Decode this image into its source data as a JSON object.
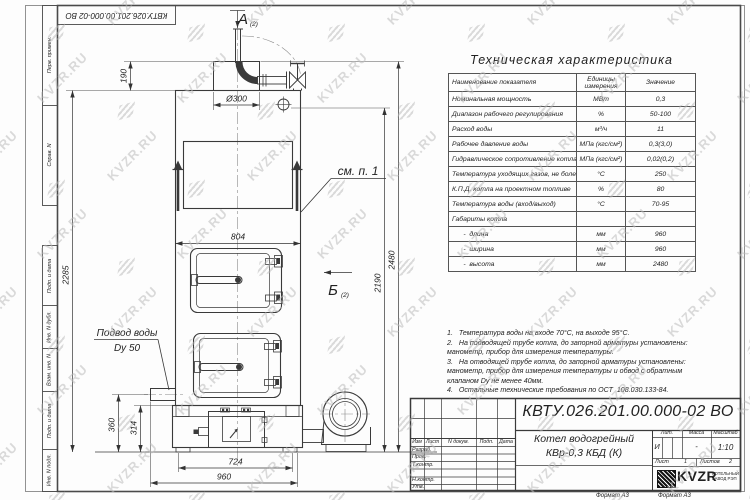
{
  "watermark": {
    "text": "KVZR.RU"
  },
  "frame": {
    "corner_designation": "КВТУ.026.201.00.000-02  ВО",
    "side_top_1": "Перв. примен.",
    "side_top_2": "Справ. N",
    "side_bot_1": "Подп. и дата",
    "side_bot_2": "Инв. N дубл.",
    "side_bot_3": "Взам. инв. N",
    "side_bot_4": "Подп. и дата",
    "side_bot_5": "Инв. N подл.",
    "format_label": "Формат А3"
  },
  "spec": {
    "title": "Техническая характеристика",
    "col_name": "Наименование показателя",
    "col_unit": "Единицы измерения",
    "col_value": "Значение",
    "rows": [
      {
        "name": "Номинальная мощность",
        "unit": "МВт",
        "value": "0,3"
      },
      {
        "name": "Диапазон рабочего регулирования",
        "unit": "%",
        "value": "50-100"
      },
      {
        "name": "Расход воды",
        "unit": "м³/ч",
        "value": "11"
      },
      {
        "name": "Рабочее давление воды",
        "unit": "МПа (кгс/см²)",
        "value": "0,3(3,0)"
      },
      {
        "name": "Гидравлическое сопротивление котла",
        "unit": "МПа (кгс/см²)",
        "value": "0,02(0,2)"
      },
      {
        "name": "Температура уходящих газов, не более",
        "unit": "°С",
        "value": "250"
      },
      {
        "name": "К.П.Д. котла на проектном топливе",
        "unit": "%",
        "value": "80"
      },
      {
        "name": "Температура воды (вход/выход)",
        "unit": "°С",
        "value": "70-95"
      },
      {
        "name": "Габариты котла",
        "unit": "",
        "value": ""
      },
      {
        "name": "      -  длина",
        "unit": "мм",
        "value": "960"
      },
      {
        "name": "      -  ширина",
        "unit": "мм",
        "value": "960"
      },
      {
        "name": "      -  высота",
        "unit": "мм",
        "value": "2480"
      }
    ]
  },
  "notes": {
    "lines": [
      "1.   Температура воды на входе 70°С, на выходе 95°С.",
      "2.   На подводящей трубе котла, до запорной арматуры установлены:",
      "манометр, прибор для измерения температуры.",
      "3.   На отводящей трубе котла, до запорной арматуры установлены:",
      "манометр, прибор для измерения температуры и обвод с обратным",
      "клапаном Dу не менее 40мм.",
      "4.   Остальные технические требования по ОСТ  108.030.133-84."
    ]
  },
  "drawing": {
    "view_a": "А",
    "view_b": "Б",
    "view_ref": "(2)",
    "see_item": "см. п. 1",
    "water_label1": "Подвод воды",
    "water_label2": "Dу 50",
    "dim_fi300": "Ø300",
    "dim_190": "190",
    "dim_2285": "2285",
    "dim_804": "804",
    "dim_2190": "2190",
    "dim_2480": "2480",
    "dim_360": "360",
    "dim_314": "314",
    "dim_724": "724",
    "dim_960": "960"
  },
  "title_block": {
    "designation": "КВТУ.026.201.00.000-02  ВО",
    "name_line1": "Котел водогрейный",
    "name_line2": "КВр-0,3  КБД  (К)",
    "col_izm": "Изм",
    "col_list": "Лист",
    "col_doc": "N докум.",
    "col_sign": "Подп.",
    "col_date": "Дата",
    "role_1": "Разраб.",
    "role_2": "Пров.",
    "role_3": "Т.контр.",
    "role_4": "Н.контр.",
    "role_5": "Утв.",
    "lit_label": "Лит.",
    "lit_value": "И",
    "mass_label": "Масса",
    "mass_value": "-",
    "scale_label": "Масштаб",
    "scale_value": "1:10",
    "sheet_label": "Лист",
    "sheet_value": "1",
    "sheets_label": "Листов",
    "sheets_value": "2",
    "logo_text": "KVZR",
    "logo_sub1": "КОТЕЛЬНЫЙ",
    "logo_sub2": "ЗАВОД РЭП"
  }
}
